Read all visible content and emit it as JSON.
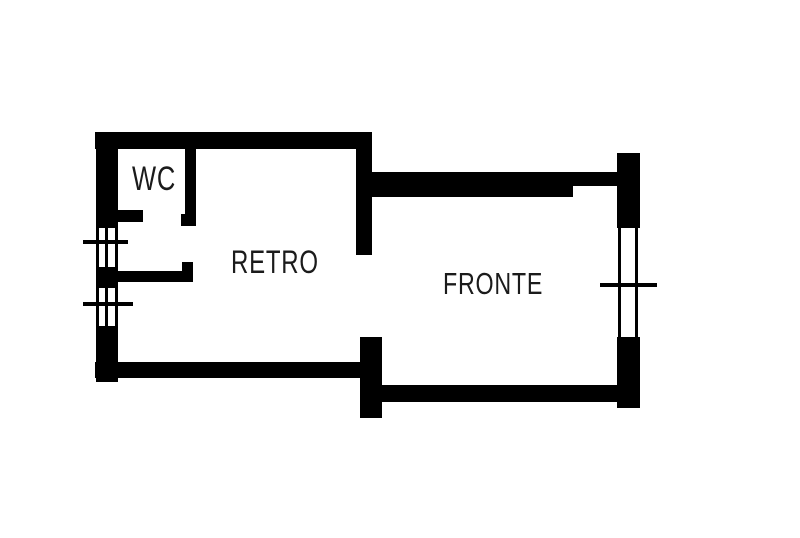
{
  "colors": {
    "wall": "#000000",
    "text": "#1b1b1b",
    "background": "#ffffff"
  },
  "rooms": [
    {
      "id": "wc",
      "label": "WC",
      "x": 132,
      "y": 162,
      "font_size": 34
    },
    {
      "id": "retro",
      "label": "RETRO",
      "x": 231,
      "y": 246,
      "font_size": 32
    },
    {
      "id": "fronte",
      "label": "FRONTE",
      "x": 443,
      "y": 268,
      "font_size": 31
    }
  ],
  "floorplan": {
    "walls": [
      {
        "name": "top-wall",
        "x": 95,
        "y": 132,
        "w": 277,
        "h": 17
      },
      {
        "name": "left-wall",
        "x": 96,
        "y": 132,
        "w": 22,
        "h": 250
      },
      {
        "name": "wc-bottom-wall",
        "x": 99,
        "y": 210,
        "w": 44,
        "h": 12
      },
      {
        "name": "wc-right-wall",
        "x": 185,
        "y": 148,
        "w": 11,
        "h": 78
      },
      {
        "name": "wc-right-wall-foot",
        "x": 181,
        "y": 214,
        "w": 15,
        "h": 12
      },
      {
        "name": "storage-bottom-wall",
        "x": 99,
        "y": 271,
        "w": 94,
        "h": 11
      },
      {
        "name": "storage-wall-stub",
        "x": 182,
        "y": 262,
        "w": 11,
        "h": 12
      },
      {
        "name": "retro-fronte-divider-wall",
        "x": 356,
        "y": 132,
        "w": 16,
        "h": 123
      },
      {
        "name": "fronte-top-wall",
        "x": 372,
        "y": 172,
        "w": 201,
        "h": 25
      },
      {
        "name": "fronte-top-wall-recess",
        "x": 573,
        "y": 172,
        "w": 45,
        "h": 14
      },
      {
        "name": "right-wall",
        "x": 617,
        "y": 153,
        "w": 23,
        "h": 255
      },
      {
        "name": "fronte-bottom-wall",
        "x": 382,
        "y": 385,
        "w": 236,
        "h": 17
      },
      {
        "name": "entry-pillar",
        "x": 360,
        "y": 337,
        "w": 22,
        "h": 81
      },
      {
        "name": "retro-bottom-wall",
        "x": 95,
        "y": 362,
        "w": 265,
        "h": 16
      }
    ],
    "windows": [
      {
        "name": "left-window-upper",
        "rect": {
          "x": 96,
          "y": 228,
          "w": 22,
          "h": 39
        },
        "lines": [
          {
            "x": 96,
            "y": 228,
            "w": 3,
            "h": 39
          },
          {
            "x": 105,
            "y": 228,
            "w": 3,
            "h": 39
          },
          {
            "x": 115,
            "y": 228,
            "w": 3,
            "h": 39
          }
        ]
      },
      {
        "name": "left-window-lower",
        "rect": {
          "x": 96,
          "y": 288,
          "w": 22,
          "h": 38
        },
        "lines": [
          {
            "x": 96,
            "y": 288,
            "w": 3,
            "h": 38
          },
          {
            "x": 105,
            "y": 288,
            "w": 3,
            "h": 38
          },
          {
            "x": 115,
            "y": 288,
            "w": 3,
            "h": 38
          }
        ]
      },
      {
        "name": "right-window",
        "rect": {
          "x": 617,
          "y": 228,
          "w": 23,
          "h": 109
        },
        "lines": [
          {
            "x": 618,
            "y": 228,
            "w": 3,
            "h": 109
          },
          {
            "x": 635,
            "y": 228,
            "w": 3,
            "h": 109
          }
        ]
      }
    ],
    "ticks": [
      {
        "name": "left-window-upper-tick",
        "x": 83,
        "y": 240,
        "w": 45,
        "h": 4
      },
      {
        "name": "left-window-lower-tick",
        "x": 83,
        "y": 302,
        "w": 50,
        "h": 4
      },
      {
        "name": "right-window-tick",
        "x": 600,
        "y": 283,
        "w": 57,
        "h": 4
      }
    ]
  }
}
